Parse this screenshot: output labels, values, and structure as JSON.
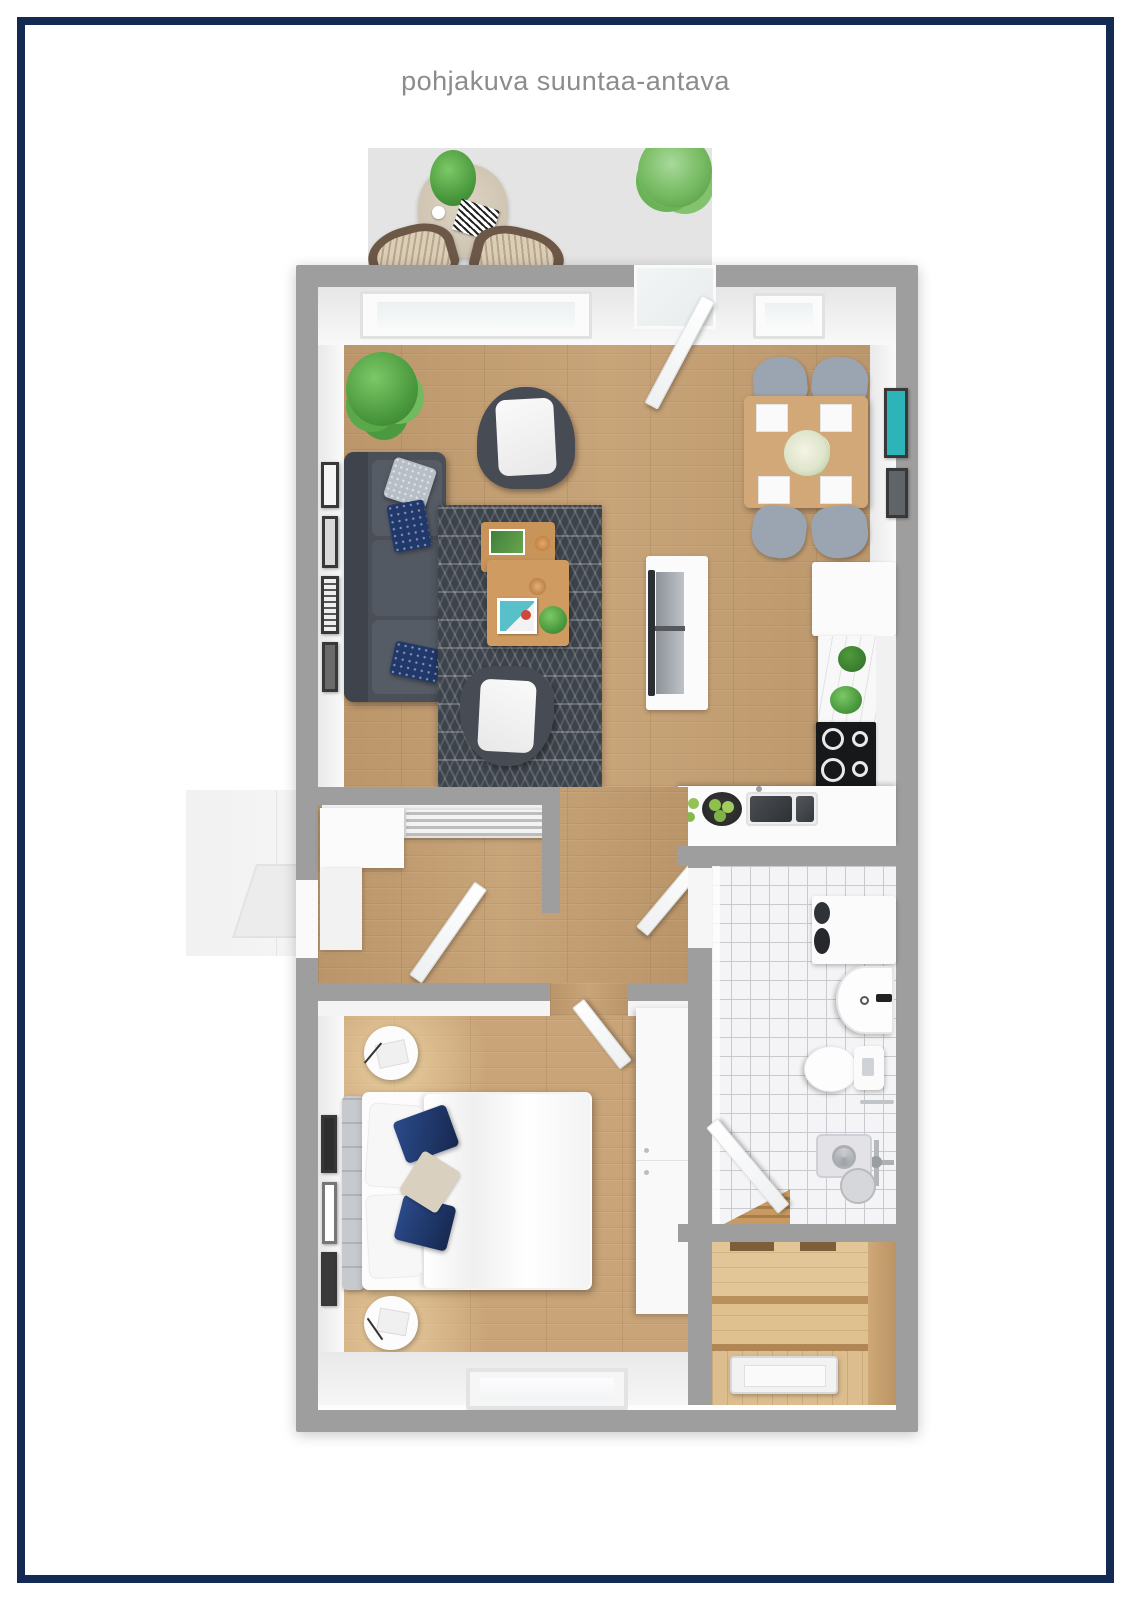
{
  "page": {
    "title": "pohjakuva suuntaa-antava"
  },
  "palette": {
    "frame": "#132a52",
    "background": "#ffffff",
    "wall": "#9e9e9e",
    "innerWall": "#f4f4f4",
    "woodFloor": "#c49d6f",
    "bedroomFloor": "#c9a478",
    "saunaWood": "#dcbd8e",
    "terrace": "#e4e4e4",
    "tile": "#f4f4f6",
    "tileGrout": "#c9c9d0",
    "rug": "#3d434b",
    "sofa": "#4b5058",
    "armchair": "#474c54",
    "diningChair": "#9aa5b1",
    "tableWood": "#d3a878",
    "navyPillow": "#21386b",
    "plant": "#56ad49",
    "artTeal": "#2cb4b8",
    "cooktop": "#17181a",
    "titleText": "#8c8c8c"
  },
  "floorplan": {
    "rooms": [
      "terrace",
      "living-room",
      "dining-area",
      "kitchen",
      "entry-hall",
      "bedroom",
      "bathroom",
      "sauna"
    ]
  }
}
